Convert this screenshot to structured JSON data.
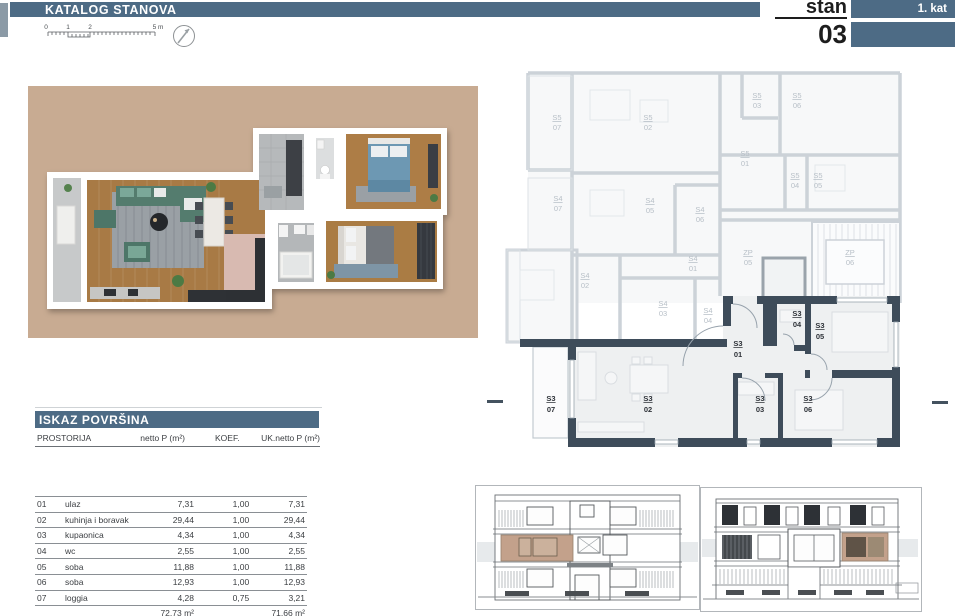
{
  "header": {
    "title": "KATALOG STANOVA",
    "unit_label": "stan",
    "unit_number": "03",
    "floor_label": "1. kat"
  },
  "scale_bar": {
    "tick0": "0",
    "tick1": "1",
    "tick2": "2",
    "tick_end": "5 m"
  },
  "colors": {
    "accent_blue": "#4d6b85",
    "tan_background": "#c8ab92",
    "highlight_wall": "#3e4c5a",
    "faded_plan": "#ccd2d8",
    "elevation_highlight": "#c3a18b"
  },
  "floorplan2d": {
    "faded_units": [
      {
        "code": "S5",
        "num": "07"
      },
      {
        "code": "S5",
        "num": "02"
      },
      {
        "code": "S5",
        "num": "03"
      },
      {
        "code": "S5",
        "num": "06"
      },
      {
        "code": "S5",
        "num": "01"
      },
      {
        "code": "S5",
        "num": "04"
      },
      {
        "code": "S5",
        "num": "05"
      },
      {
        "code": "S4",
        "num": "07"
      },
      {
        "code": "S4",
        "num": "05"
      },
      {
        "code": "S4",
        "num": "06"
      },
      {
        "code": "S4",
        "num": "01"
      },
      {
        "code": "S4",
        "num": "02"
      },
      {
        "code": "S4",
        "num": "03"
      },
      {
        "code": "S4",
        "num": "04"
      },
      {
        "code": "ZP",
        "num": "05"
      },
      {
        "code": "ZP",
        "num": "06"
      }
    ],
    "s3_units": [
      {
        "code": "S3",
        "num": "01"
      },
      {
        "code": "S3",
        "num": "02"
      },
      {
        "code": "S3",
        "num": "03"
      },
      {
        "code": "S3",
        "num": "04"
      },
      {
        "code": "S3",
        "num": "05"
      },
      {
        "code": "S3",
        "num": "06"
      },
      {
        "code": "S3",
        "num": "07"
      }
    ]
  },
  "areas_table": {
    "title": "ISKAZ POVRŠINA",
    "col_room": "PROSTORIJA",
    "col_netto": "netto P (m²)",
    "col_koef": "KOEF.",
    "col_uk": "UK.netto P (m²)",
    "rows": [
      {
        "num": "01",
        "name": "ulaz",
        "netto": "7,31",
        "koef": "1,00",
        "uk": "7,31"
      },
      {
        "num": "02",
        "name": "kuhinja i boravak",
        "netto": "29,44",
        "koef": "1,00",
        "uk": "29,44"
      },
      {
        "num": "03",
        "name": "kupaonica",
        "netto": "4,34",
        "koef": "1,00",
        "uk": "4,34"
      },
      {
        "num": "04",
        "name": "wc",
        "netto": "2,55",
        "koef": "1,00",
        "uk": "2,55"
      },
      {
        "num": "05",
        "name": "soba",
        "netto": "11,88",
        "koef": "1,00",
        "uk": "11,88"
      },
      {
        "num": "06",
        "name": "soba",
        "netto": "12,93",
        "koef": "1,00",
        "uk": "12,93"
      },
      {
        "num": "07",
        "name": "loggia",
        "netto": "4,28",
        "koef": "0,75",
        "uk": "3,21"
      }
    ],
    "total_netto": "72,73 m²",
    "total_uk": "71,66 m²"
  }
}
